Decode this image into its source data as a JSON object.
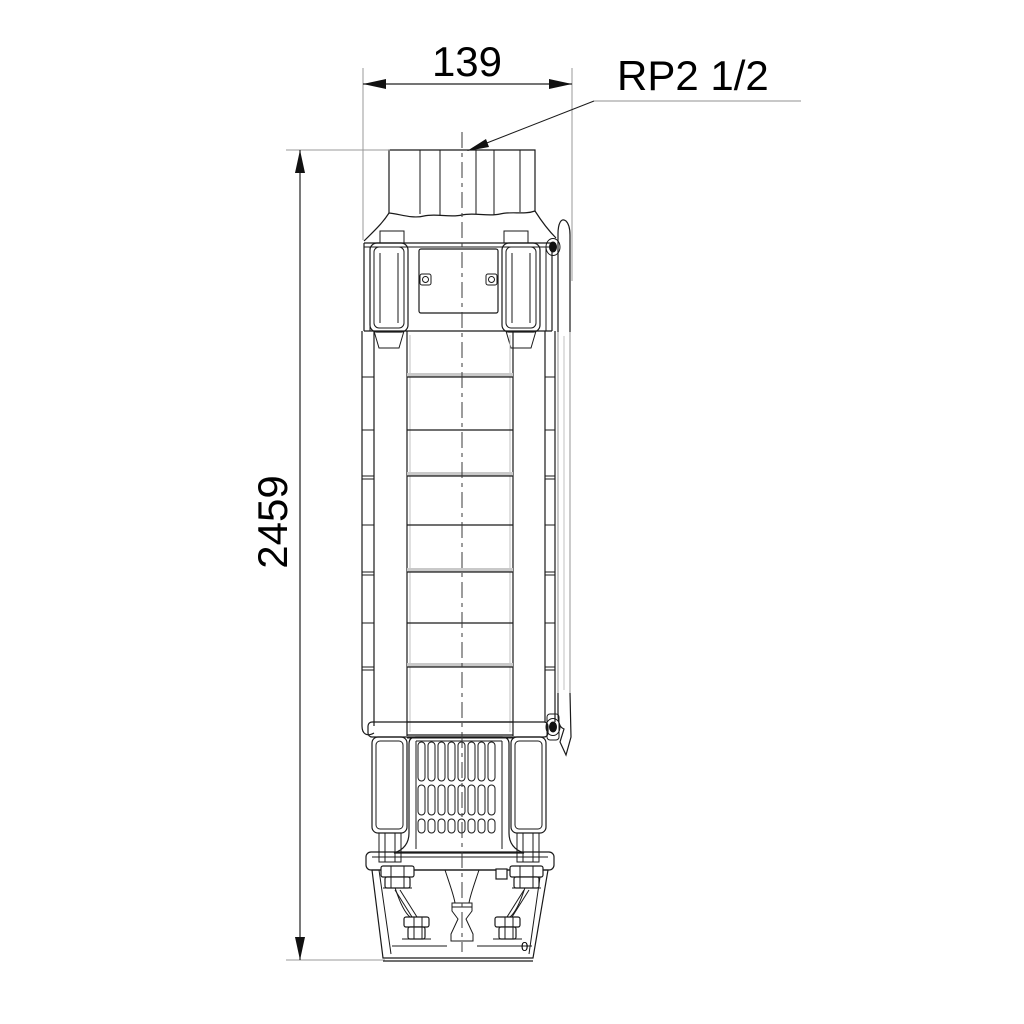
{
  "page": {
    "background_color": "#ffffff",
    "kind": "technical dimensional drawing",
    "subject": "submersible borehole pump, front elevation outline"
  },
  "drawing": {
    "dimensions": {
      "width": {
        "value": "139",
        "orientation": "horizontal",
        "position": "top"
      },
      "height": {
        "value": "2459",
        "orientation": "vertical",
        "position": "left"
      },
      "connection": {
        "label": "RP2 1/2",
        "target": "discharge thread at pump top"
      }
    },
    "marks": {
      "motor_mark": "0"
    },
    "style": {
      "line_color": "#1a1a1a",
      "extension_line_color": "#999999",
      "leader_underline_color": "#a8a8a8",
      "centerline_color": "#3a3a3a",
      "stage_shading_color": "#c9c9c9",
      "background": "#ffffff"
    }
  }
}
